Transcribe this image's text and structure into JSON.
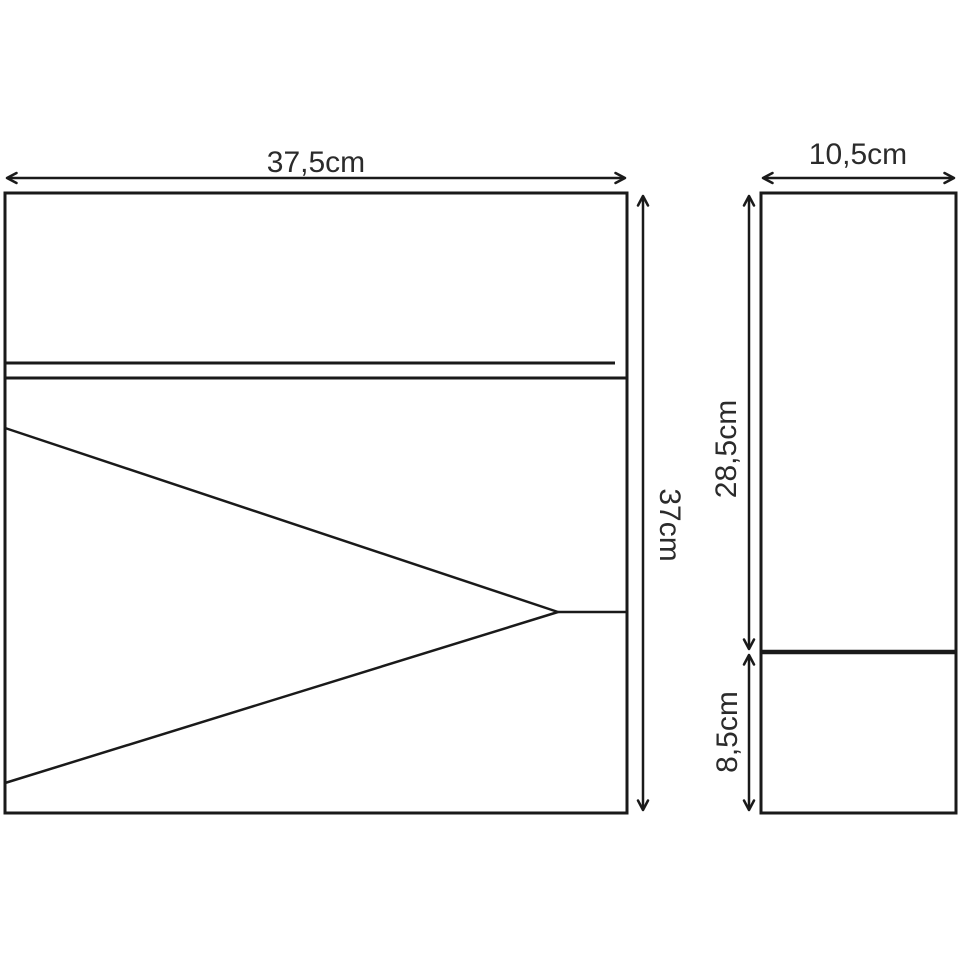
{
  "colors": {
    "background": "#ffffff",
    "line": "#1a1a1a",
    "text": "#2b2b2b"
  },
  "views": {
    "front": {
      "width_label": "37,5cm",
      "height_label": "37cm"
    },
    "side": {
      "width_label": "10,5cm",
      "upper_section_label": "28,5cm",
      "lower_section_label": "8,5cm"
    }
  }
}
